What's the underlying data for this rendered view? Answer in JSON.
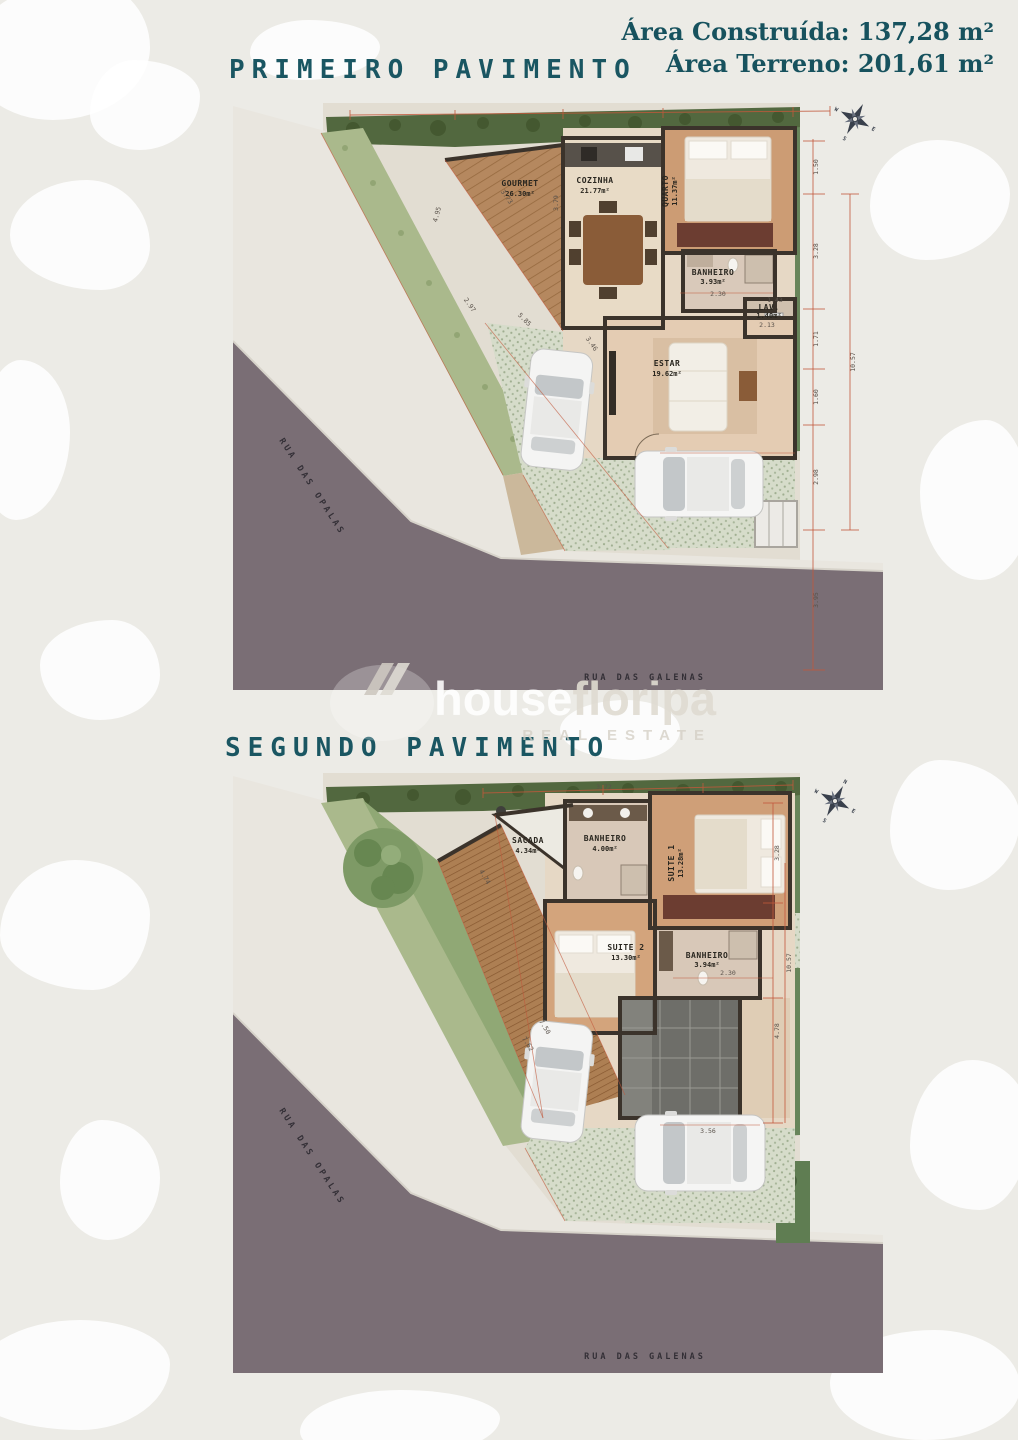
{
  "header": {
    "area_construida": "Área Construída: 137,28 m²",
    "area_terreno": "Área Terreno: 201,61 m²"
  },
  "watermark": {
    "brand_a": "house",
    "brand_b": "floripa",
    "tagline": "REAL ESTATE"
  },
  "streets": {
    "opalas": "RUA DAS OPALAS",
    "galenas": "RUA DAS GALENAS"
  },
  "compass": {
    "n": "N",
    "e": "E",
    "s": "S",
    "w": "W"
  },
  "plan1": {
    "title": "PRIMEIRO PAVIMENTO",
    "rooms": {
      "gourmet": {
        "name": "GOURMET",
        "area": "26.30m²"
      },
      "cozinha": {
        "name": "COZINHA",
        "area": "21.77m²"
      },
      "quarto": {
        "name": "QUARTO",
        "area": "11.37m²"
      },
      "banheiro": {
        "name": "BANHEIRO",
        "area": "3.93m²"
      },
      "lav": {
        "name": "LAV.",
        "area": "1.40m²"
      },
      "estar": {
        "name": "ESTAR",
        "area": "19.62m²"
      }
    },
    "dims": {
      "right_chain": [
        "1.50",
        "3.28",
        "1.71",
        "1.60",
        "2.98"
      ],
      "right_lower": "3.95",
      "right_total": "10.57",
      "interior": [
        "4.95",
        "3.73",
        "3.79",
        "2.30",
        "2.13",
        "1.43",
        "5.85",
        "3.46",
        "2.97"
      ]
    }
  },
  "plan2": {
    "title": "SEGUNDO PAVIMENTO",
    "rooms": {
      "sacada": {
        "name": "SACADA",
        "area": "4.34m²"
      },
      "banheiro1": {
        "name": "BANHEIRO",
        "area": "4.00m²"
      },
      "suite1": {
        "name": "SUITE 1",
        "area": "13.28m²"
      },
      "suite2": {
        "name": "SUITE 2",
        "area": "13.30m²"
      },
      "banheiro2": {
        "name": "BANHEIRO",
        "area": "3.94m²"
      }
    },
    "dims": {
      "top": "3.72",
      "left_diag": "4.74",
      "drive_diag1": "7.50",
      "drive_diag2": "7.62",
      "bottom": "3.56",
      "inner": "2.30",
      "right1": "4.78",
      "right_total": "10.57",
      "right2": "3.28"
    }
  }
}
